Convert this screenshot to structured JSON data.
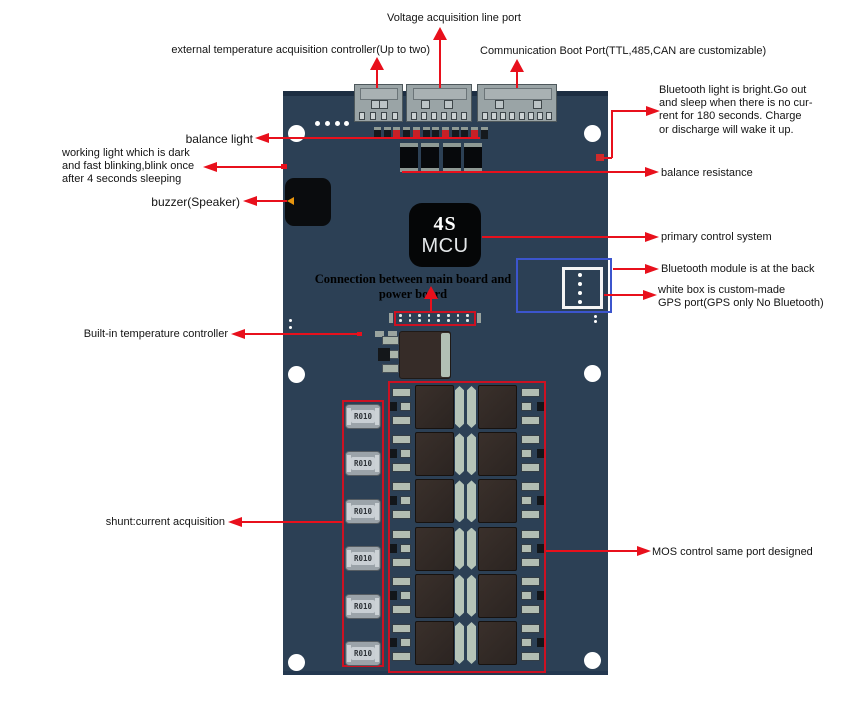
{
  "annotations": {
    "voltage_port": "Voltage acquisition line port",
    "ext_temp": "external temperature acquisition controller(Up to two)",
    "comm_port": "Communication Boot Port(TTL,485,CAN are customizable)",
    "bt_light": "Bluetooth light is bright.Go out\nand sleep when there is no cur-\nrent for 180 seconds. Charge\nor discharge will wake it up.",
    "balance_light": "balance light",
    "working_light": "working light which is dark\nand fast blinking,blink once\nafter 4 seconds sleeping",
    "balance_resistance": "balance resistance",
    "buzzer": "buzzer(Speaker)",
    "primary_control": "primary control system",
    "connection": "Connection between main board and power board",
    "bt_module": "Bluetooth module is at the back",
    "gps_port": "white box is custom-made\nGPS port(GPS only No Bluetooth)",
    "builtin_temp": "Built-in temperature controller",
    "shunt": "shunt:current acquisition",
    "mos_control": "MOS control same port designed"
  },
  "board": {
    "mcu_line1": "4S",
    "mcu_line2": "MCU",
    "shunt_label": "R010",
    "shunt_count": 6,
    "mos_rows": 6,
    "mos_columns": 2,
    "colors": {
      "board": "#2c4055",
      "annotation_red": "#e8101c",
      "component_box_red": "#cc1122",
      "gps_box_blue": "#3c55cd"
    }
  }
}
